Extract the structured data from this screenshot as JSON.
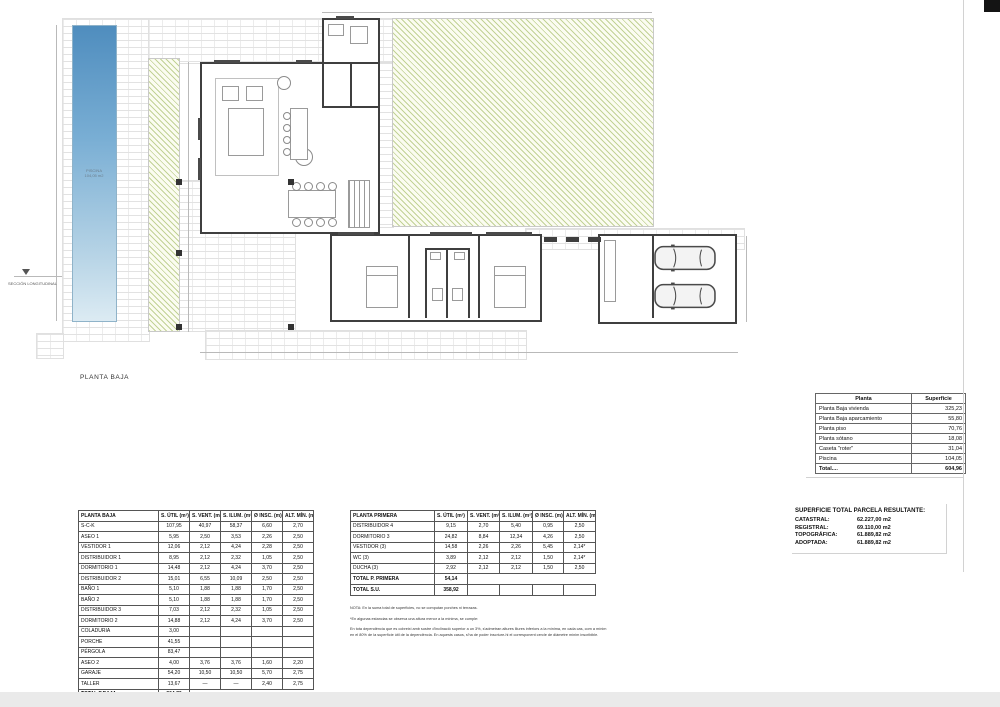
{
  "plan": {
    "title": "PLANTA BAJA",
    "section_label": "SECCIÓN LONGITUDINAL",
    "pool": {
      "name": "PISCINA",
      "area": "104,05 m2"
    }
  },
  "summary_table": {
    "headers": [
      "Planta",
      "Superficie"
    ],
    "rows": [
      [
        "Planta Baja vivienda",
        "325,23"
      ],
      [
        "Planta Baja aparcamiento",
        "55,80"
      ],
      [
        "Planta piso",
        "70,76"
      ],
      [
        "Planta sótano",
        "18,08"
      ],
      [
        "Caseta \"roter\"",
        "31,04"
      ],
      [
        "Piscina",
        "104,05"
      ]
    ],
    "totals": [
      [
        "Total....",
        "604,96"
      ]
    ]
  },
  "planta_baja_table": {
    "headers": [
      "PLANTA BAJA",
      "S. ÚTIL (m²)",
      "S. VENT. (m²)",
      "S. ILUM. (m²)",
      "Ø INSC. (m)",
      "ALT. MÍN. (m)"
    ],
    "rows": [
      [
        "S-C-K",
        "107,95",
        "40,97",
        "58,37",
        "6,60",
        "2,70"
      ],
      [
        "ASEO 1",
        "5,95",
        "2,50",
        "3,53",
        "2,26",
        "2,50"
      ],
      [
        "VESTIDOR 1",
        "12,06",
        "2,12",
        "4,24",
        "2,28",
        "2,50"
      ],
      [
        "DISTRIBUIDOR 1",
        "8,95",
        "2,12",
        "2,32",
        "1,05",
        "2,50"
      ],
      [
        "DORMITORIO 1",
        "14,48",
        "2,12",
        "4,24",
        "3,70",
        "2,50"
      ],
      [
        "DISTRIBUIDOR 2",
        "15,01",
        "6,55",
        "10,09",
        "2,50",
        "2,50"
      ],
      [
        "BAÑO 1",
        "5,10",
        "1,88",
        "1,88",
        "1,70",
        "2,50"
      ],
      [
        "BAÑO 2",
        "5,10",
        "1,88",
        "1,88",
        "1,70",
        "2,50"
      ],
      [
        "DISTRIBUIDOR 3",
        "7,03",
        "2,12",
        "2,32",
        "1,05",
        "2,50"
      ],
      [
        "DORMITORIO 2",
        "14,88",
        "2,12",
        "4,24",
        "3,70",
        "2,50"
      ],
      [
        "COLADURIA",
        "3,00",
        "",
        "",
        "",
        ""
      ],
      [
        "PORCHE",
        "41,55",
        "",
        "",
        "",
        ""
      ],
      [
        "PÉRGOLA",
        "83,47",
        "",
        "",
        "",
        ""
      ],
      [
        "ASEO 2",
        "4,00",
        "3,76",
        "3,76",
        "1,60",
        "2,20"
      ],
      [
        "GARAJE",
        "54,20",
        "10,50",
        "10,50",
        "5,70",
        "2,75"
      ],
      [
        "TALLER",
        "13,67",
        "—",
        "—",
        "2,40",
        "2,75"
      ]
    ],
    "totals": [
      [
        "TOTAL P.BAJA",
        "304,76"
      ]
    ]
  },
  "planta_primera_table": {
    "headers": [
      "PLANTA PRIMERA",
      "S. ÚTIL (m²)",
      "S. VENT. (m²)",
      "S. ILUM. (m²)",
      "Ø INSC. (m)",
      "ALT. MÍN. (m)"
    ],
    "rows": [
      [
        "DISTRIBUIDOR 4",
        "9,15",
        "2,70",
        "5,40",
        "0,95",
        "2,50"
      ],
      [
        "DORMITORIO 3",
        "24,82",
        "8,84",
        "12,34",
        "4,26",
        "2,50"
      ],
      [
        "VESTIDOR (3)",
        "14,58",
        "2,26",
        "2,26",
        "5,45",
        "2,14*"
      ],
      [
        "WC (3)",
        "3,89",
        "2,12",
        "2,12",
        "1,50",
        "2,14*"
      ],
      [
        "DUCHA (3)",
        "2,92",
        "2,12",
        "2,12",
        "1,50",
        "2,50"
      ]
    ],
    "totals": [
      [
        "TOTAL P. PRIMERA",
        "54,14"
      ]
    ],
    "grand": [
      [
        "TOTAL S.U.",
        "358,92",
        "",
        "",
        "",
        ""
      ]
    ]
  },
  "notes": {
    "line1": "NOTA: En la suma total de superficies, no se computan porches ni terrazas.",
    "line2": "*En algunas estancias se observa una altura menor a la mínima, se cumple:",
    "line3": "En tota dependència que es cobreixi amb sostre d'inclinació superior a un 3%, s'admetran altures lliures inferiors a la mínima, en cada cas, com a mínim en el 80% de la superfície útil de la dependència. En aquests casos, s'ha de poder inscriure-hi el corresponent cercle de diàmetre mínim inscribible."
  },
  "parcel": {
    "title": "SUPERFICIE TOTAL PARCELA RESULTANTE:",
    "rows": [
      [
        "CATASTRAL:",
        "62.227,00 m2"
      ],
      [
        "REGISTRAL:",
        "69.110,00 m2"
      ],
      [
        "TOPOGRÁFICA:",
        "61.889,82 m2"
      ],
      [
        "ADOPTADA:",
        "61.889,82 m2"
      ]
    ]
  },
  "colors": {
    "lawn_hatch": "#94af4c",
    "pool_top": "#4f8dbe",
    "wall": "#3f3f3f"
  }
}
